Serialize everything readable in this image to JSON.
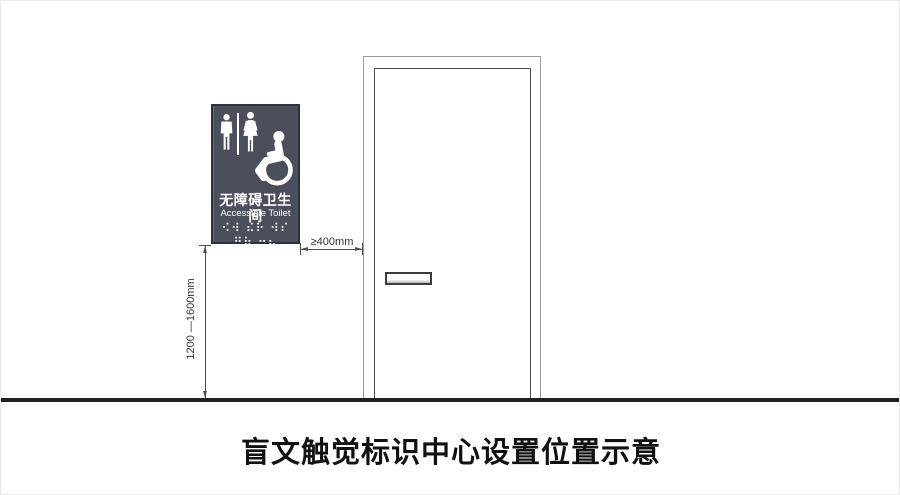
{
  "page": {
    "caption": "盲文触觉标识中心设置位置示意",
    "background_color": "#ffffff"
  },
  "sign": {
    "title_zh": "无障碍卫生间",
    "title_en": "Accessible Toilet",
    "braille_text": "⠪⠺ ⠮⠗ ⠺⠎ ⠛⠷ ⠒⠦",
    "bg_color": "#4a4f5b",
    "border_color": "#2e323b",
    "pictogram_color": "#ffffff",
    "icons": [
      "male-figure-icon",
      "female-figure-icon",
      "wheelchair-icon"
    ]
  },
  "door": {
    "frame_color": "#9b9b9b",
    "panel_color": "#4f4f4f",
    "handle_color": "#3c3c3c"
  },
  "dimensions": {
    "horizontal_label": "≥400mm",
    "vertical_label": "1200 —1600mm",
    "line_color": "#4d4d4d"
  },
  "ground": {
    "color": "#202020"
  }
}
